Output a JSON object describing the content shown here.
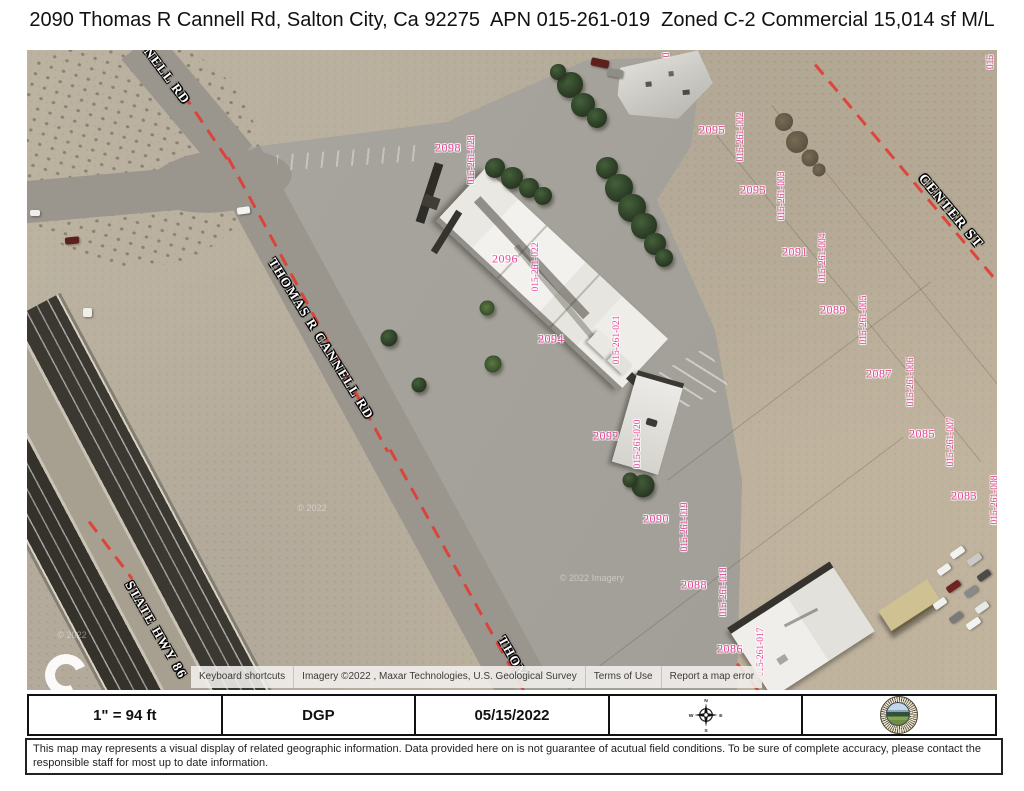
{
  "title": "2090 Thomas R Cannell Rd, Salton City, Ca 92275  APN 015-261-019  Zoned C-2 Commercial 15,014 sf M/L",
  "map": {
    "street_labels": [
      {
        "text": "NELL RD",
        "x": 140,
        "y": 26,
        "rot": 53,
        "size": 13
      },
      {
        "text": "THOMAS R CANNELL RD",
        "x": 294,
        "y": 289,
        "rot": 58,
        "size": 13
      },
      {
        "text": "THOM",
        "x": 486,
        "y": 608,
        "rot": 60,
        "size": 13
      },
      {
        "text": "STATE HWY 86",
        "x": 129,
        "y": 580,
        "rot": 60,
        "size": 13
      },
      {
        "text": "CENTER ST",
        "x": 923,
        "y": 162,
        "rot": 50,
        "size": 14
      }
    ],
    "lot_labels": [
      {
        "text": "2098",
        "x": 421,
        "y": 98
      },
      {
        "text": "2096",
        "x": 478,
        "y": 209
      },
      {
        "text": "2094",
        "x": 524,
        "y": 289
      },
      {
        "text": "2092",
        "x": 579,
        "y": 386
      },
      {
        "text": "2090",
        "x": 629,
        "y": 469
      },
      {
        "text": "2088",
        "x": 667,
        "y": 535
      },
      {
        "text": "2086",
        "x": 703,
        "y": 599
      },
      {
        "text": "2095",
        "x": 685,
        "y": 80
      },
      {
        "text": "2093",
        "x": 726,
        "y": 140
      },
      {
        "text": "2091",
        "x": 768,
        "y": 202
      },
      {
        "text": "2089",
        "x": 806,
        "y": 260
      },
      {
        "text": "2087",
        "x": 852,
        "y": 324
      },
      {
        "text": "2085",
        "x": 895,
        "y": 384
      },
      {
        "text": "2083",
        "x": 937,
        "y": 446
      }
    ],
    "apn_labels": [
      {
        "text": "015-261-023",
        "x": 445,
        "y": 110
      },
      {
        "text": "015-261-022",
        "x": 509,
        "y": 217
      },
      {
        "text": "015-261-021",
        "x": 590,
        "y": 290
      },
      {
        "text": "015-261-020",
        "x": 611,
        "y": 394
      },
      {
        "text": "015-261-019",
        "x": 658,
        "y": 477
      },
      {
        "text": "015-261-018",
        "x": 697,
        "y": 542
      },
      {
        "text": "015-261-017",
        "x": 734,
        "y": 602
      },
      {
        "text": "015-261-002",
        "x": 714,
        "y": 87
      },
      {
        "text": "015-261-003",
        "x": 755,
        "y": 146
      },
      {
        "text": "015-261-004",
        "x": 796,
        "y": 208
      },
      {
        "text": "015-261-005",
        "x": 837,
        "y": 270
      },
      {
        "text": "015-261-006",
        "x": 884,
        "y": 332
      },
      {
        "text": "015-261-007",
        "x": 924,
        "y": 392
      },
      {
        "text": "015-261-008",
        "x": 968,
        "y": 450
      },
      {
        "text": "015",
        "x": 964,
        "y": 12
      },
      {
        "text": "0",
        "x": 640,
        "y": 5
      }
    ],
    "watermarks": [
      {
        "text": "© 2022",
        "x": 285,
        "y": 458
      },
      {
        "text": "© 2022 Imagery",
        "x": 565,
        "y": 528
      },
      {
        "text": "© 2022",
        "x": 45,
        "y": 585
      }
    ],
    "attribution": {
      "keyboard_shortcuts": "Keyboard shortcuts",
      "imagery_credit": "Imagery ©2022 , Maxar Technologies, U.S. Geological Survey",
      "terms_of_use": "Terms of Use",
      "report_error": "Report a map error"
    }
  },
  "footer": {
    "scale": "1\" = 94 ft",
    "preparer": "DGP",
    "date": "05/15/2022",
    "compass": {
      "n": "N",
      "s": "S",
      "e": "E",
      "w": "W"
    }
  },
  "disclaimer": "This map may represents a visual display of related geographic information. Data provided here on is not guarantee of acutual field conditions. To be sure of complete accuracy, please contact the responsible staff for most up to date information.",
  "colors": {
    "parcel_label": "#ee459d",
    "boundary_red": "#e23b31"
  }
}
